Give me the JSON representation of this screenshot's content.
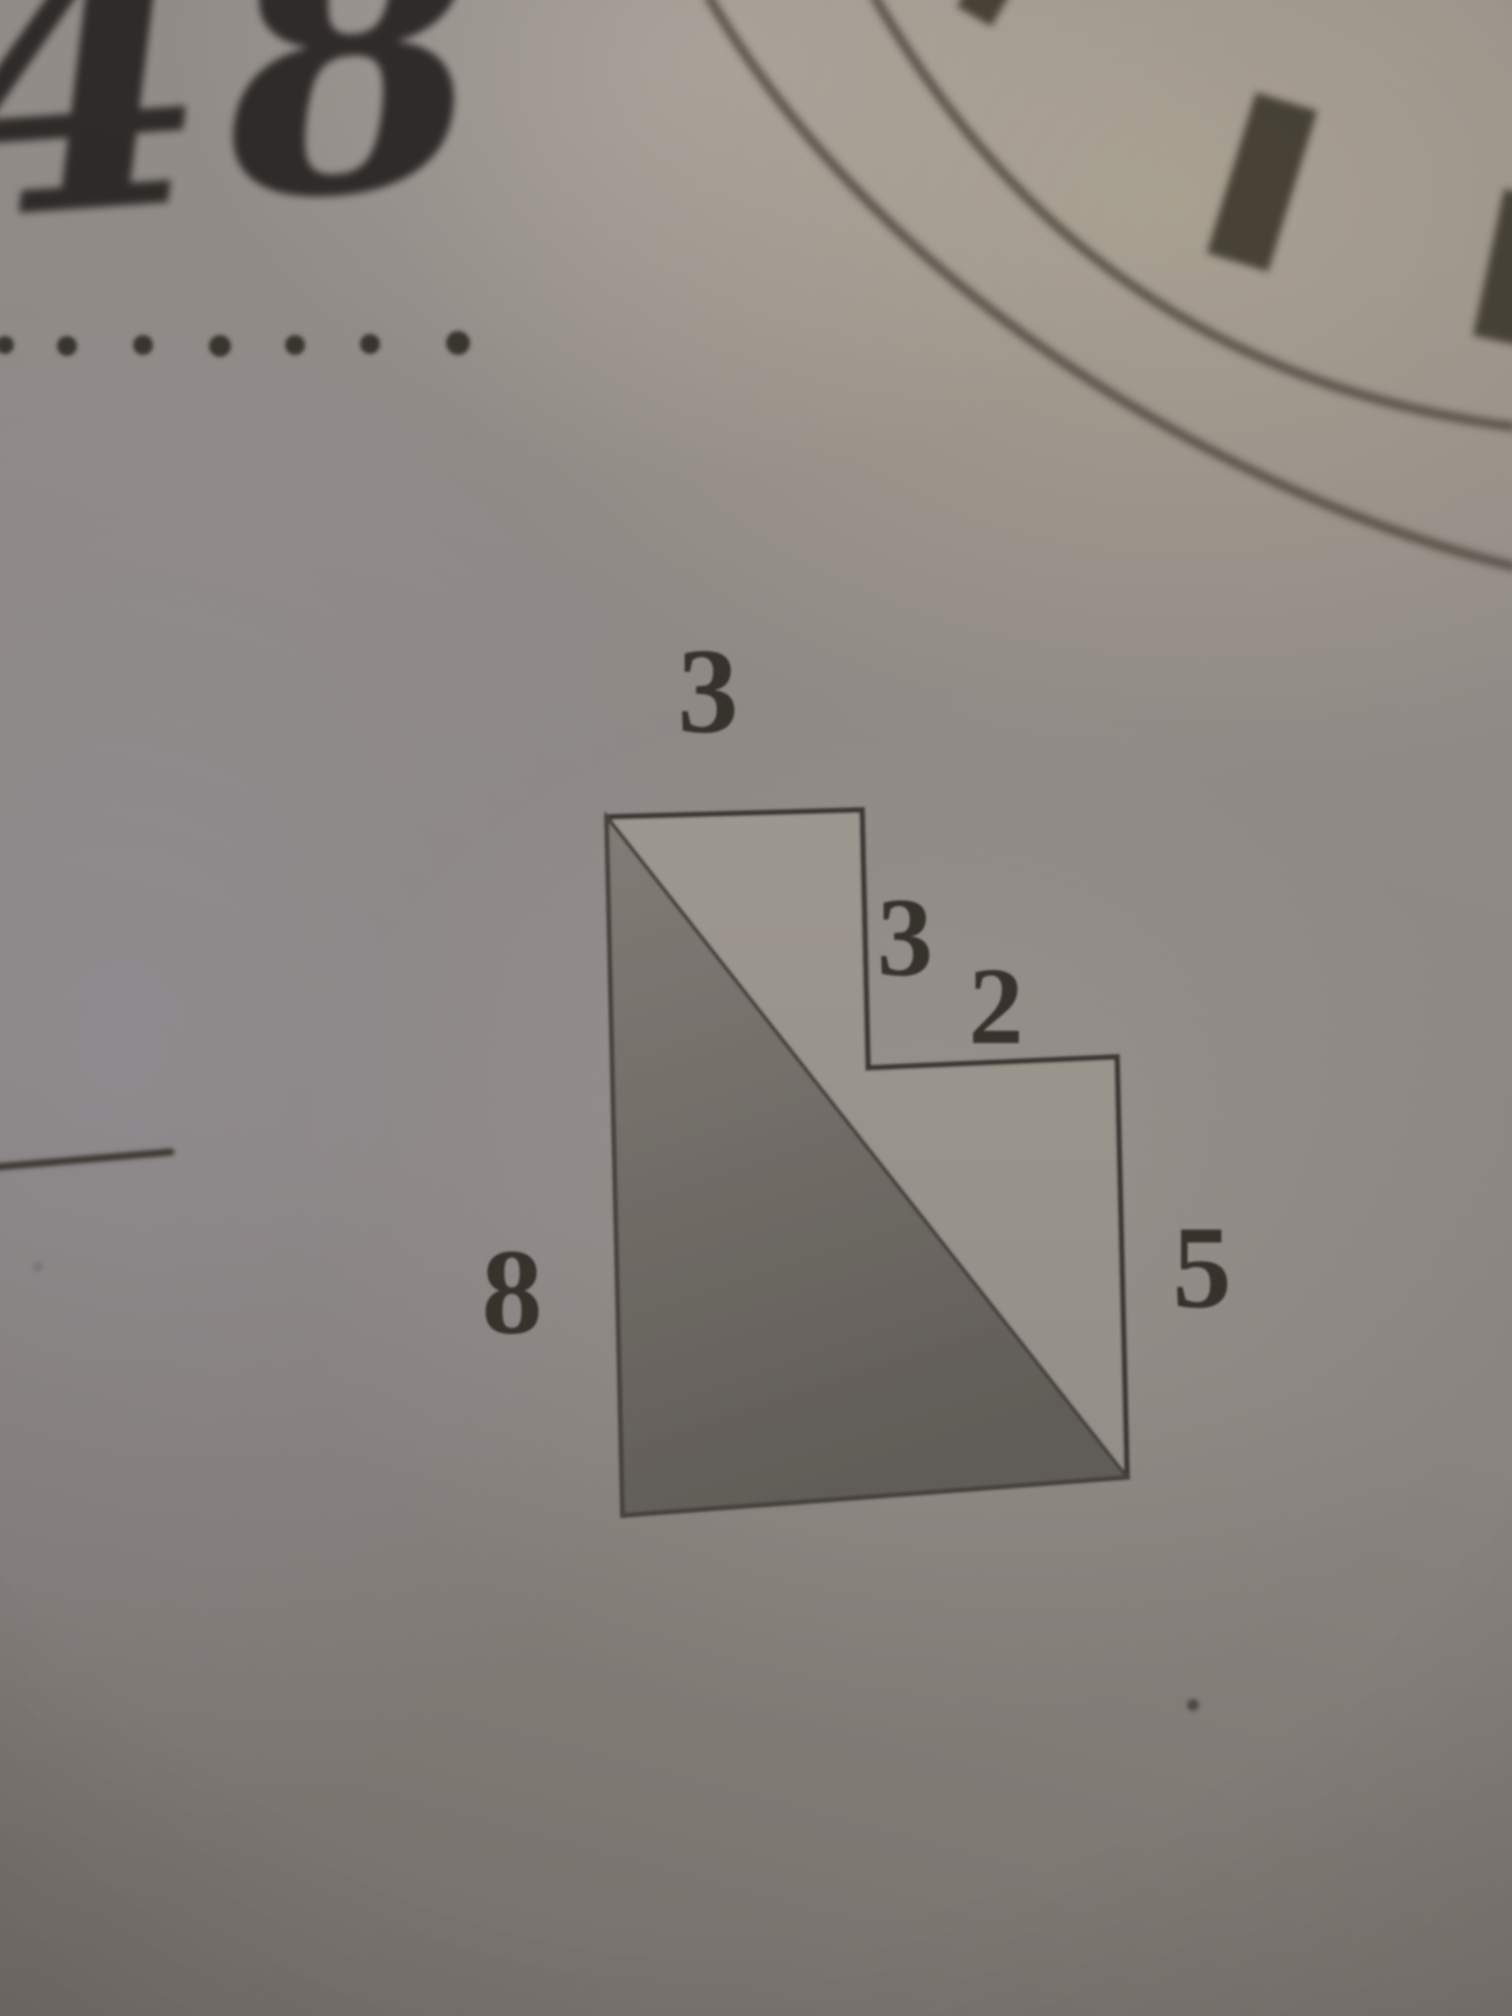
{
  "photo": {
    "handwritten_number": "48",
    "stamp": {
      "arc_count": 2,
      "tick_count": 3
    },
    "dotted_line": {
      "dot_count": 7
    },
    "stray_dot_count": 2
  },
  "figure": {
    "type": "staircase polygon with shaded right triangle",
    "labels": {
      "top": "3",
      "step_right": "3",
      "step_top": "2",
      "right": "5",
      "left": "8"
    },
    "side_lengths": {
      "top": 3,
      "step_down": 3,
      "step_across": 2,
      "right": 5,
      "left": 8
    }
  },
  "colors": {
    "paper": "#8f8a86",
    "ink": "#36322c",
    "outline": "#3d3934",
    "triangle_shade": "#6e6a63"
  }
}
